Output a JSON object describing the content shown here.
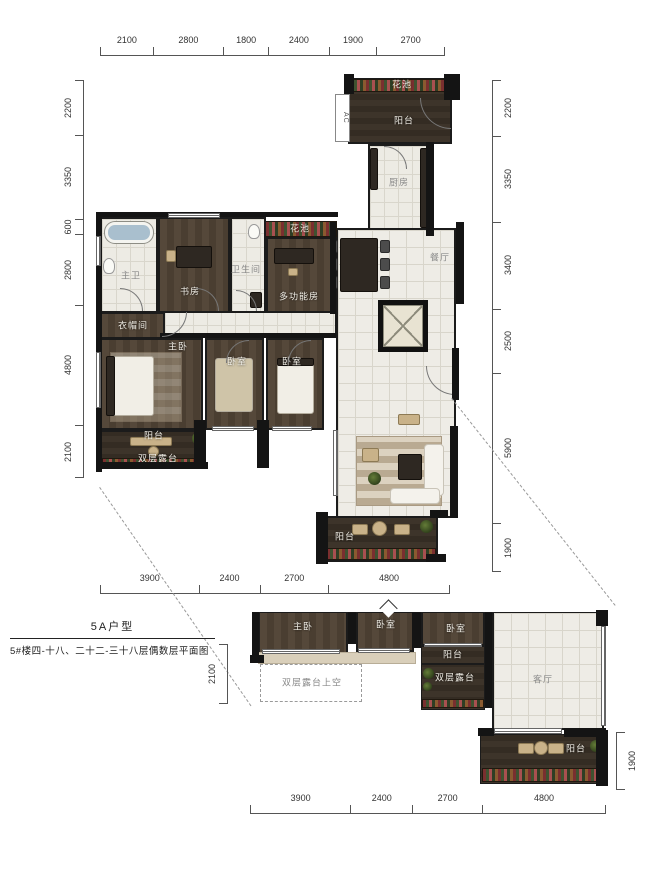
{
  "title_block": {
    "name": "5A户型",
    "description": "5#楼四-十八、二十二-三十八层偶数层平面图"
  },
  "upper_plan": {
    "dims_top": [
      "2100",
      "2800",
      "1800",
      "2400",
      "1900",
      "2700"
    ],
    "dims_left": [
      "2200",
      "3350",
      "600",
      "2800",
      "4800",
      "2100"
    ],
    "dims_right": [
      "2200",
      "3350",
      "3400",
      "2500",
      "5900",
      "1900"
    ],
    "dims_bottom": [
      "3900",
      "2400",
      "2700",
      "4800"
    ],
    "labels": {
      "flower_top": "花池",
      "balcony_top": "阳台",
      "ac": "AC",
      "kitchen": "厨房",
      "dining": "餐厅",
      "flower_mid": "花池",
      "multi": "多功能房",
      "bath2": "卫生间",
      "study": "书房",
      "master_bath": "主卫",
      "closet": "衣帽间",
      "master_bed": "主卧",
      "bed2": "卧室",
      "bed3": "卧室",
      "balcony_left": "阳台",
      "terrace_left": "双层露台",
      "balcony_bottom": "阳台"
    }
  },
  "lower_plan": {
    "dims_left": [
      "2100"
    ],
    "dims_right": [
      "1900"
    ],
    "dims_bottom": [
      "3900",
      "2400",
      "2700",
      "4800"
    ],
    "labels": {
      "master_bed": "主卧",
      "bed2": "卧室",
      "bed3": "卧室",
      "balcony_small": "阳台",
      "terrace": "双层露台",
      "terrace_void": "双层露台上空",
      "living": "客厅",
      "balcony_bottom": "阳台"
    }
  }
}
